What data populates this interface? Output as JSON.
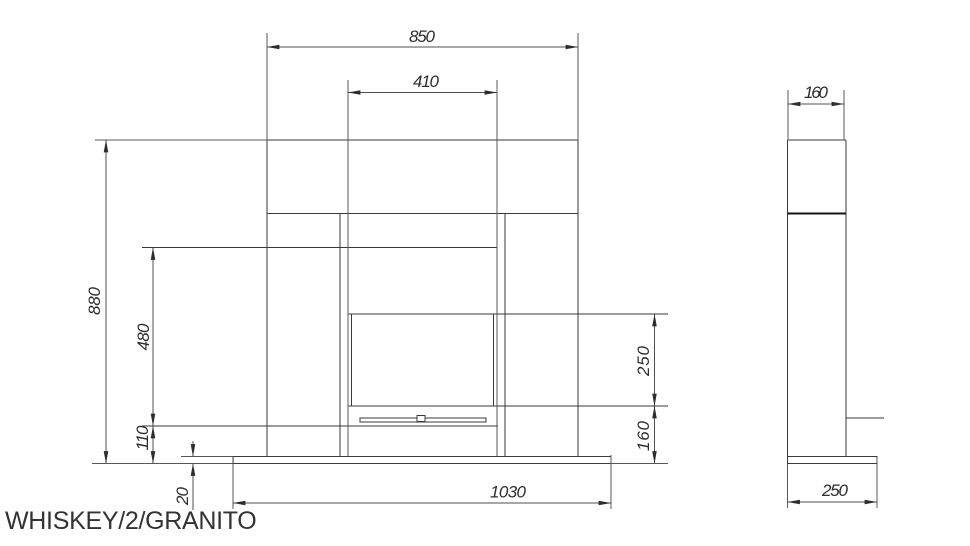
{
  "title": "WHISKEY/2/GRANITO",
  "dimensions": {
    "front": {
      "shelf_width": "850",
      "firebox_width": "410",
      "overall_height": "880",
      "recess_height": "480",
      "hearth_clearance": "110",
      "hearth_thickness": "20",
      "hearth_width": "1030",
      "firebox_height": "250",
      "firebox_bottom_height": "160"
    },
    "side": {
      "shelf_depth": "160",
      "hearth_depth": "250"
    }
  }
}
